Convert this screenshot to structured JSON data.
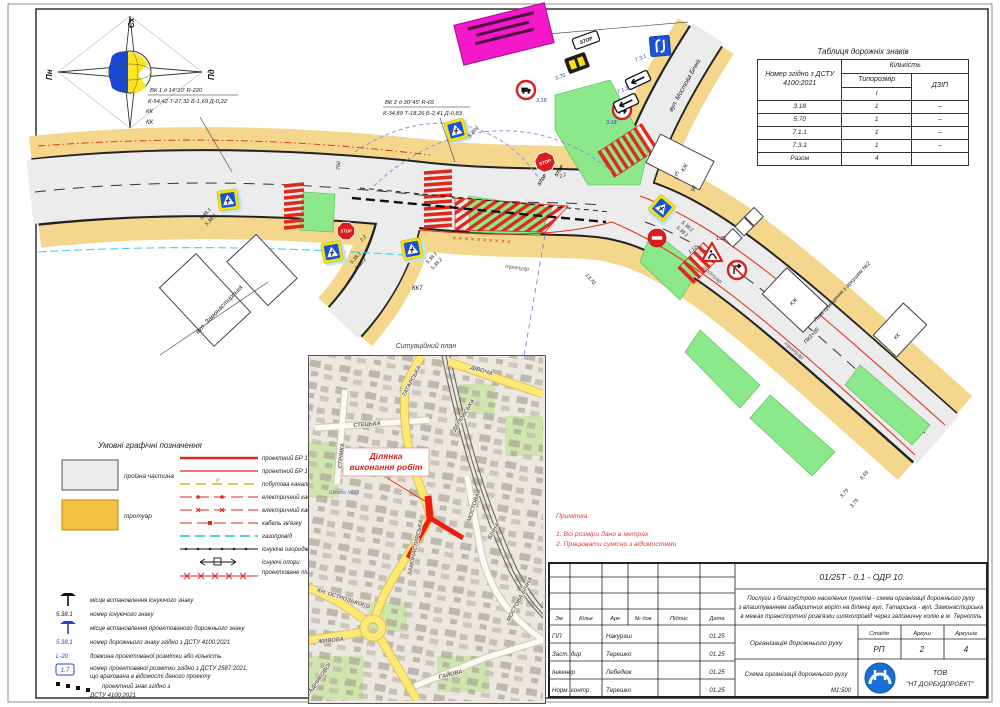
{
  "compass": {
    "e": "Сх",
    "n": "Пн",
    "s": "Пд",
    "w": "Зх"
  },
  "plan": {
    "curve1_l1": "ВК 1 д 14°10' R-220",
    "curve1_l2": "К-54,42 Т-27,32 Б-1,69 Д-0,22",
    "curve1_l3": "КК",
    "curve2_l1": "ВК 2 д 30°45' R-65",
    "curve2_l2": "К-34,89 Т-18,26 Б-2,41 Д-0,83",
    "street_mostova": "вул. Мостова Бічна",
    "street_zamon": "вул. Замонастирська",
    "sidewalk": "тротуар",
    "match_line": "Лінія суміщення з аркушем №2",
    "match_pk": "ПК3+85",
    "kk": "КК",
    "kk7": "КК7",
    "kzh": "КЖ",
    "fence_x": "××××××××××",
    "d750": "750",
    "d175": "175",
    "d98": "98",
    "d1370": "13,70",
    "d565": "5,65",
    "d375": "3,75",
    "ped1": "5.38.1",
    "ped2": "5.38.2",
    "stop_no": "2.2",
    "no_trucks": "3.18",
    "board570": "5.70",
    "tab711": "7.1.1",
    "tab731": "7.3.1",
    "works": "1.32",
    "mark112": "1.12",
    "stop_word": "STOP"
  },
  "signs_table": {
    "title": "Таблиця дорожніх знаків",
    "h_num": "Номер згідно з ДСТУ 4100:2021",
    "h_qty": "Кількість",
    "h_size": "Типорозмір",
    "h_size_i": "I",
    "h_dzip": "ДЗІП",
    "r1_num": "3.18",
    "r1_q": "1",
    "r1_d": "–",
    "r2_num": "5.70",
    "r2_q": "1",
    "r2_d": "–",
    "r3_num": "7.1.1",
    "r3_q": "1",
    "r3_d": "–",
    "r4_num": "7.3.1",
    "r4_q": "1",
    "r4_d": "–",
    "rt_num": "Разом",
    "rt_q": "4",
    "rt_d": ""
  },
  "legend": {
    "title": "Умовні графічні позначення",
    "sw1": "проїзна частина",
    "sw2": "тротуар",
    "ln1": "проектний БР 100.30.18",
    "ln2": "проектний БР 100.20.8",
    "ln3": "побутова каналізація",
    "ln4": "електричний кабель",
    "ln5": "електричний кабель",
    "ln6": "кабель зв'язку",
    "ln7": "газопровід",
    "ln8": "існуюче огородження",
    "ln9": "існуючі опори",
    "ln10": "проектоване пішохідне огородження",
    "k": "К",
    "m1": "місце встановлення існуючого знаку",
    "m2": "номер існуючого знаку",
    "m3": "місце встановлення проектованого дорожнього знаку",
    "m4": "номер дорожнього знаку згідно з ДСТУ 4100:2021",
    "m5": "довжина проектованої розмітки або кількість",
    "m6a": "номер проектованої розмітки згідно з ДСТУ 2587:2021,",
    "m6b": "що врахована в відомості даного проекту",
    "m7a": "проектний знак згідно з",
    "m7b": "ДСТУ 4100:2021",
    "sym_num": "5.38.1",
    "sym_len": "L-20",
    "sym_mark": "1.7"
  },
  "sitplan": {
    "title": "Ситуаційний план",
    "callout1": "Ділянка",
    "callout2": "виконання робіт",
    "school": "Школа №13",
    "st_tatarska": "ТАТАРСЬКА",
    "st_divocha": "ДІВОЧА",
    "st_depovska": "ДЕПОВСЬКА",
    "st_stetska": "СТЕЦЬКА",
    "st_zamon": "ЗАМОНАСТИРСЬКА",
    "st_strimka": "СТРІМКА",
    "st_ostroz": "КН. ОСТРОЗЬКОГО",
    "st_zhyvova": "ЖИВОВА",
    "st_stadnyk": "СТАДНИКОВОЇ",
    "st_mostova": "МОСТОВА",
    "st_bichna": "БІЧНА",
    "st_mostb": "МОСТОВА БІЧНА",
    "st_haiova": "ГАЙОВА"
  },
  "notes": {
    "title": "Примітка:",
    "n1": "1. Всі розміри дано в метрах",
    "n2": "2. Працювати сумісно з відомостями"
  },
  "titleblock": {
    "doc": "01/25Т - 0.1 - ОДР 10",
    "desc1": "Послуги з благоустрою населених пунктів - схема організації дорожнього руху",
    "desc2": "з влаштуванням габаритних воріт на ділянці вул. Татарська - вул. Замонастирська",
    "desc3": "в межах транспортної розв'язки шляхопровід через залізничну колію в м. Тернопіль",
    "h_zm": "Зм",
    "h_kilk": "Кільк",
    "h_ark": "Арк",
    "h_ndok": "№ док",
    "h_pidpys": "Підпис",
    "h_data": "Дата",
    "r1_role": "ГІП",
    "r1_name": "Накураш",
    "r1_date": "01.25",
    "r2_role": "Заст. дир",
    "r2_name": "Терешко",
    "r2_date": "01.25",
    "r3_role": "Інженер",
    "r3_name": "Лебедюк",
    "r3_date": "01.25",
    "r4_role": "Норм. контр",
    "r4_name": "Терешко",
    "r4_date": "01.25",
    "section": "Організація дорожнього руху",
    "stage_l": "Стадія",
    "sheet_l": "Аркуш",
    "sheets_l": "Аркушів",
    "stage": "РП",
    "sheet": "2",
    "sheets": "4",
    "drawing": "Схема організації дорожнього руху",
    "scale": "М1:500",
    "company1": "ТОВ",
    "company2": "\"НТ ДОРБУДПРОЕКТ\""
  }
}
